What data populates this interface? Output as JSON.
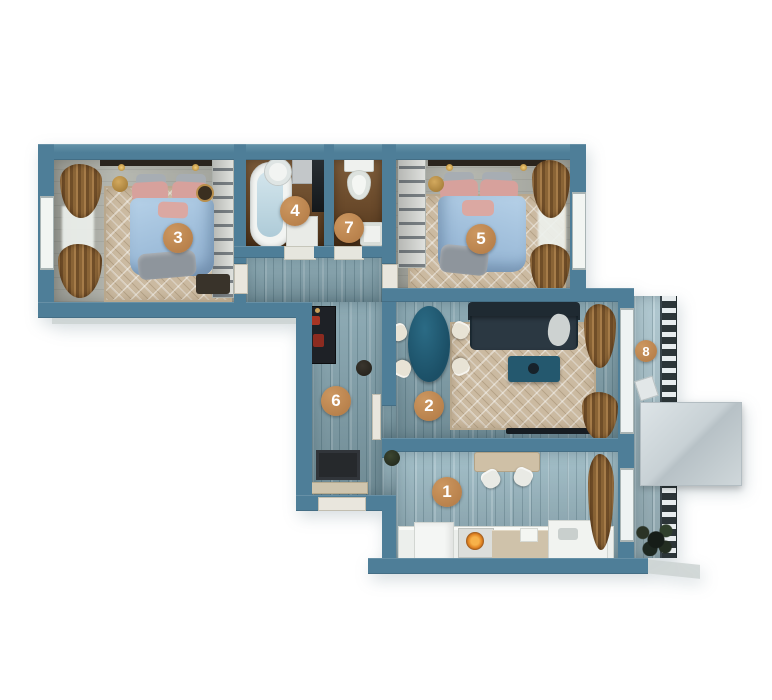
{
  "plan": {
    "kind": "3d-apartment-floor-plan",
    "rooms": [
      {
        "label": "1",
        "name": "kitchen"
      },
      {
        "label": "2",
        "name": "living-room"
      },
      {
        "label": "3",
        "name": "bedroom-1"
      },
      {
        "label": "4",
        "name": "bathroom"
      },
      {
        "label": "5",
        "name": "bedroom-2"
      },
      {
        "label": "6",
        "name": "hallway"
      },
      {
        "label": "7",
        "name": "toilet"
      },
      {
        "label": "8",
        "name": "balcony"
      }
    ]
  },
  "colors": {
    "wall": "#4e7e98",
    "marker": "#bc8450",
    "wood_floor": "#82a2ad",
    "carpet": "#cbbaa1",
    "bath_floor": "#6d4c2c",
    "bed": "#a9c7e2",
    "sofa": "#26323b",
    "table": "#1e5670",
    "curtain": "#8a6436",
    "awning": "#ccd5d9"
  }
}
